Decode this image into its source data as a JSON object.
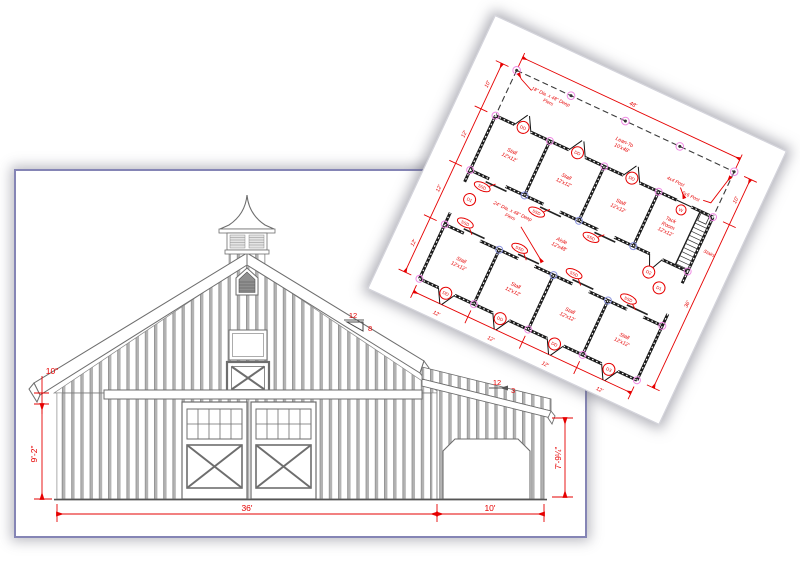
{
  "colors": {
    "dimension_red": "#e60000",
    "wall_black": "#1b1b1b",
    "pier_ring_pink": "#ef8ae4",
    "pier_ring_blue": "#8b93dd",
    "elevation_sheet_border": "#8585b5",
    "siding_gray": "#b3b3b3",
    "background": "#ffffff"
  },
  "elevation": {
    "dims": {
      "overhang": "10\"",
      "wall_height": "9'-2\"",
      "main_width": "36'",
      "leanto_width": "10'",
      "leanto_height": "7'-9¼\""
    },
    "roof_pitch_main": {
      "run": "12",
      "rise": "8"
    },
    "roof_pitch_leanto": {
      "run": "12",
      "rise": "3"
    }
  },
  "plan": {
    "dims": {
      "overall_width": "48'",
      "leanto_depth": "10'",
      "bay": "12'",
      "barn_depth": "36'"
    },
    "rooms": {
      "stall": {
        "name": "Stall",
        "size": "12'x12'"
      },
      "tack": {
        "name": "Tack",
        "name2": "Room",
        "size": "12'x12'"
      },
      "aisle": {
        "name": "Aisle",
        "size": "12'x48'"
      },
      "lean_to": {
        "name": "Lean-To",
        "size": "10'x48'"
      }
    },
    "notes": {
      "piers18_l1": "18\" Dia. x 48\" Deep",
      "piers24_l1": "24\" Dia. x 48\" Deep",
      "piers_l2": "Piers",
      "post_6x6": "6x6 Post",
      "post_4x4": "4x4 Post",
      "stairs": "Stairs"
    },
    "tags": {
      "dutch_door": "DD",
      "sliding_stall_door": "SSD",
      "door1": "D1",
      "door2": "D2",
      "door3": "D3",
      "window": "W"
    }
  }
}
